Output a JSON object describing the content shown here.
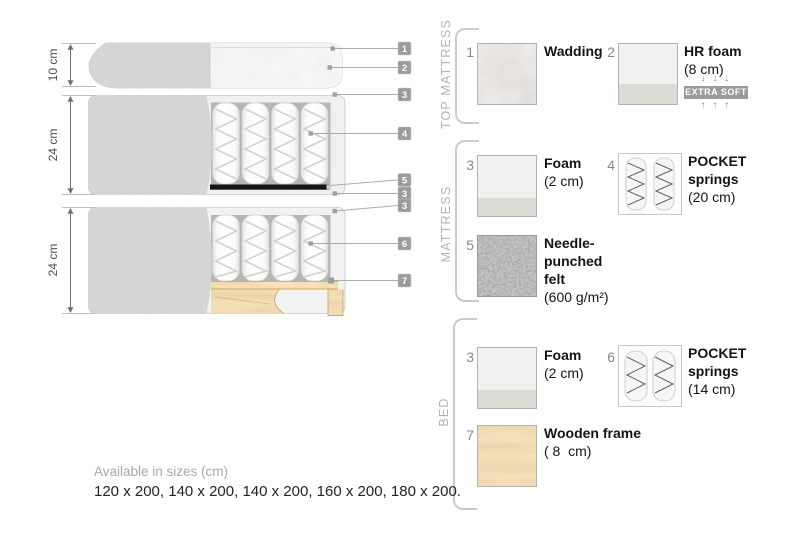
{
  "diagram": {
    "dims": {
      "top_mattress": "10 cm",
      "mattress": "24 cm",
      "bed": "24 cm"
    },
    "tags": {
      "t1": "1",
      "t2": "2",
      "t3": "3",
      "t4": "4",
      "t5": "5",
      "t6": "3",
      "t7": "3",
      "t8": "6",
      "t9": "7"
    }
  },
  "legend": {
    "top_mattress": {
      "title": "TOP MATTRESS",
      "wadding": {
        "num": "1",
        "line1": "Wadding"
      },
      "hr_foam": {
        "num": "2",
        "line1": "HR foam",
        "line2": "(8 cm)",
        "arrows_down": "↓ ↓ ↓",
        "badge": "EXTRA SOFT",
        "arrows_up": "↑ ↑ ↑"
      }
    },
    "mattress": {
      "title": "MATTRESS",
      "foam": {
        "num": "3",
        "line1": "Foam",
        "line2": "(2 cm)"
      },
      "pocket_springs": {
        "num": "4",
        "line1": "POCKET",
        "line2": "springs",
        "line3": "(20 cm)"
      },
      "felt": {
        "num": "5",
        "line1": "Needle-",
        "line2": "punched",
        "line3": "felt",
        "line4": "(600 g/m²)"
      }
    },
    "bed": {
      "title": "BED",
      "foam": {
        "num": "3",
        "line1": "Foam",
        "line2": "(2 cm)"
      },
      "pocket_springs": {
        "num": "6",
        "line1": "POCKET",
        "line2": "springs",
        "line3": "(14 cm)"
      },
      "wooden_frame": {
        "num": "7",
        "line1": "Wooden frame",
        "line2": "( 8  cm)"
      }
    }
  },
  "footer": {
    "label": "Available in sizes (cm)",
    "sizes": "120 x 200, 140 x 200, 140 x 200, 160 x 200, 180 x 200."
  },
  "colors": {
    "fabric_gray": "#ababab",
    "foam_light": "#f0f0ee",
    "cavity_gray": "#b5b5b4",
    "felt_black": "#161616",
    "wood_tan": "#e0b573",
    "tag_gray": "#9b9b9b",
    "badge_gray": "#9b9b9b",
    "text_dark": "#141414",
    "muted_gray": "#a9a9a9"
  }
}
